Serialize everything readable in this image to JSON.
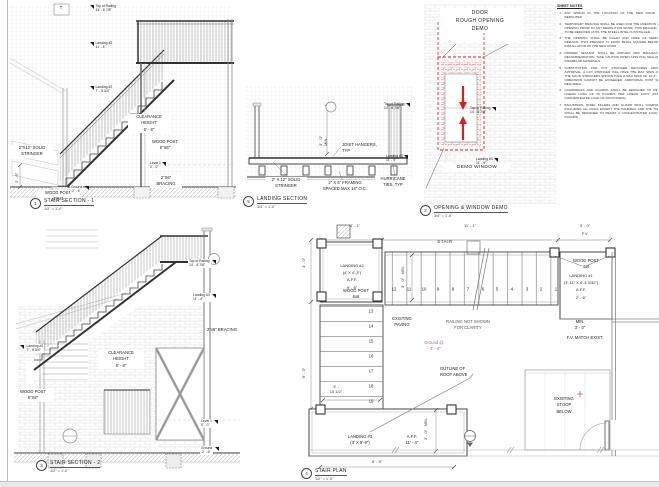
{
  "colors": {
    "demo_red": "#cc2a2a",
    "annotation_magenta": "#c0559e",
    "line_dark": "#333333",
    "hatch_light": "#e3e3e3"
  },
  "sheet": {
    "notes_heading": "SHEET NOTES",
    "notes": [
      {
        "n": "1.",
        "t": "ANY WIRING IN THE LOCATION OF THE NEW DOOR TO BE REROUTED"
      },
      {
        "n": "2.",
        "t": "TEMPORARY BRACING SHALL BE USED FOR THE CREATION OF THE OPENING PRIOR TO ANY DEMOLITION WORK. THIS BRACING IS NOT TO BE REMOVED UNTIL THE STEEL LINTEL IS INSTALLED."
      },
      {
        "n": "3.",
        "t": "THE OPENING SHALL BE CLEAN AND FREE OF DEMOLITION REMAINS THAT PREVENT IT FROM BEING SQUARE BEFORE THE INSTALLATION OF THE NEW DOOR"
      },
      {
        "n": "4.",
        "t": "PROPER SEALANT SHALL BE APPLIED PER MANUFACTURER RECOMMENDATION. TAKE CAUTION WHEN APPLYING SEALANTS TO DISSIMILAR MATERIALS"
      },
      {
        "n": "5.",
        "t": "SUBSTITUTION FOR CUT STRINGER REQUIRES ARCHITECT APPROVAL. A CUT STRINGER WILL HAVE THE MAX SPAN OF 6'-0\". THE SOLID STRINGERS SHOWN HAVE A MAX SPAN OF 13'-3\". THESE DIMENSION CANNOT BE EXCEEDED. ADDITIONAL POST WILL BE REQUIRED"
      },
      {
        "n": "6.",
        "t": "GUARDRAILS AND GUARDS SHALL BE DESIGNED TO RESIST A LINEAR LOAD OF 50 POUNDS PER LINEAR FOOT (PLF) (N/A CONCENTRATED LOAD OF 200 POUNDS)"
      },
      {
        "n": "7.",
        "t": "BALUSTERS, PANEL FILLERS AND GUARD INFILL COMPONENTS, INCLUDING ALL RAILS EXCEPT THE HANDRAIL AND THE TOP RAIL, SHALL BE DESIGNED TO RESIST A CONCENTRATED LOAD OF 50 POUNDS"
      }
    ]
  },
  "s1": {
    "num": "1",
    "title": "STAIR SECTION - 1",
    "scale": "1/2\" = 1'-0\"",
    "tag": "T",
    "top_of_railing": "Top of Railing\n14' - 8 7/8\"",
    "landing3": "Landing #3\n11' - 4\"",
    "landing2": "Landing #2\n7' - 5 3/4\"",
    "clearance": "CLEARANCE\nHEIGHT\n6' - 8\"",
    "stringer": "2\"X12\" SOLID\nSTRINGER",
    "post_6x6": "WOOD POST\n6\"X6\"",
    "level1": "Level 1\n0' - 0\"",
    "bracing": "2\"X6\"\nBRACING",
    "post_4x4": "WOOD POST\n4\"X4\"",
    "ground": "Ground\n-2' - 6\"",
    "dim_ground": "2' - 6\""
  },
  "ls": {
    "num": "5",
    "title": "LANDING SECTION",
    "scale": "3/4\" = 1'-0\"",
    "dim": "3' - 0\"\nMIN.",
    "joist": "JOIST HANGERS,\nTYP",
    "stringer": "2\" X 12\" SOLID\nSTRINGER",
    "framing": "2\" X 6\" FRAMING\nSPACED MAX 16\" O.C.",
    "hurricane": "HURRICANE\nTIES, TYP",
    "top_of_railing": "Top of Railing\n14' - 8 7/8\"",
    "landing3": "Landing #3\n11' - 4\""
  },
  "demo": {
    "num": "2",
    "title": "OPENING & WINDOW DEMO",
    "scale": "3/4\" = 1'-0\"",
    "heading": "DOOR\nROUGH OPENING\nDEMO",
    "window": "DEMO WINDOW",
    "top_of_railing": "Top of Railing\n14' - 8 7/8\"",
    "landing3": "Landing #3\n11' - 4\""
  },
  "s2": {
    "num": "3",
    "title": "STAIR SECTION - 2",
    "scale": "1/2\" = 1'-0\"",
    "top_of_railing": "Top of Railing\n14' - 8 7/8\"",
    "landing3": "Landing #3\n11' - 4\"",
    "landing2": "Landing #2\n7' - 5 3/4\"",
    "bracing": "2\"x6\" BRACING",
    "clearance": "CLEARANCE\nHEIGHT\n6' - 8\"",
    "post_6x8": "WOOD POST\n6\"X8\"",
    "level1": "Level 1\n0' - 0\"",
    "ground": "Ground\n-2' - 6\""
  },
  "plan": {
    "num": "4",
    "title": "STAIR PLAN",
    "scale": "1/2\" = 1'-0\"",
    "dim_top_left": "4' - 1\"",
    "dim_top_mid": "11' - 1\"",
    "dim_top_right": "3' - 0\"",
    "fv": "F.V.",
    "stair": "STAIR",
    "dim_left1": "4' - 0\"",
    "dim_left2": "6' - 3\"",
    "landing2": "LANDING #2\n(4' X 4'-3\")\nA.F.F.\n9' - 5\"",
    "post_6x6": "WOOD POST\n6x6",
    "min_run": "3' - 0\"   MIN.",
    "post_4x4": "WOOD POST\n4x4",
    "landing1": "LANDING #1\n(3'-11\" X 6'-3 3/32\")\nA.F.F.\n2' - 6\"",
    "paving": "EXISTING\nPAVING",
    "railing_note": "RAILING  NOT SHOWN\nFOR CLARITY",
    "ground": "Ground @\n- 2' - 6\"",
    "roof": "OUTLINE OF\nROOF ABOVE",
    "dim_flight": "3' -\n10 1/2\"",
    "min_l3": "3' - 0\"   MIN.",
    "landing3": "LANDING #3\n(3' X 8'-9\")",
    "aff3": "A.F.F.\n11' - 4\"",
    "dim_bottom": "8' - 9\"",
    "min2": "MIN.\n3' - 0\"",
    "fv_match": "F.V. MATCH EXIST.",
    "stoop": "EXISTING\nSTOOP\nBELOW",
    "treads": [
      "1",
      "2",
      "3",
      "4",
      "5",
      "6",
      "7",
      "8",
      "9",
      "10",
      "11",
      "12",
      "13",
      "14",
      "15",
      "16",
      "17",
      "18",
      "19"
    ]
  }
}
